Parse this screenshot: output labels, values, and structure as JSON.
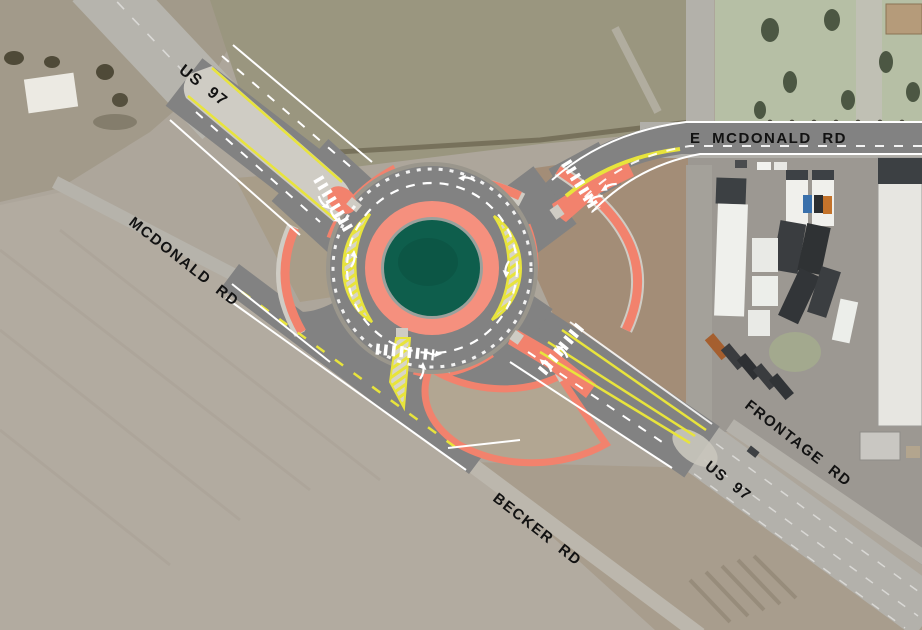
{
  "map": {
    "road_labels": {
      "us97_north": "US 97",
      "e_mcdonald": "E MCDONALD RD",
      "mcdonald": "MCDONALD RD",
      "frontage": "FRONTAGE RD",
      "us97_south": "US 97",
      "becker": "BECKER RD"
    },
    "colors": {
      "central_island_green": "#0e5e4c",
      "truck_apron_salmon": "#f5907e",
      "curb_island_salmon": "#f2826d",
      "new_pavement_gray": "#828282",
      "concrete_median_gray": "#cfccc4",
      "lane_marking_yellow": "#e8e43c",
      "lane_marking_white": "#ffffff"
    }
  }
}
